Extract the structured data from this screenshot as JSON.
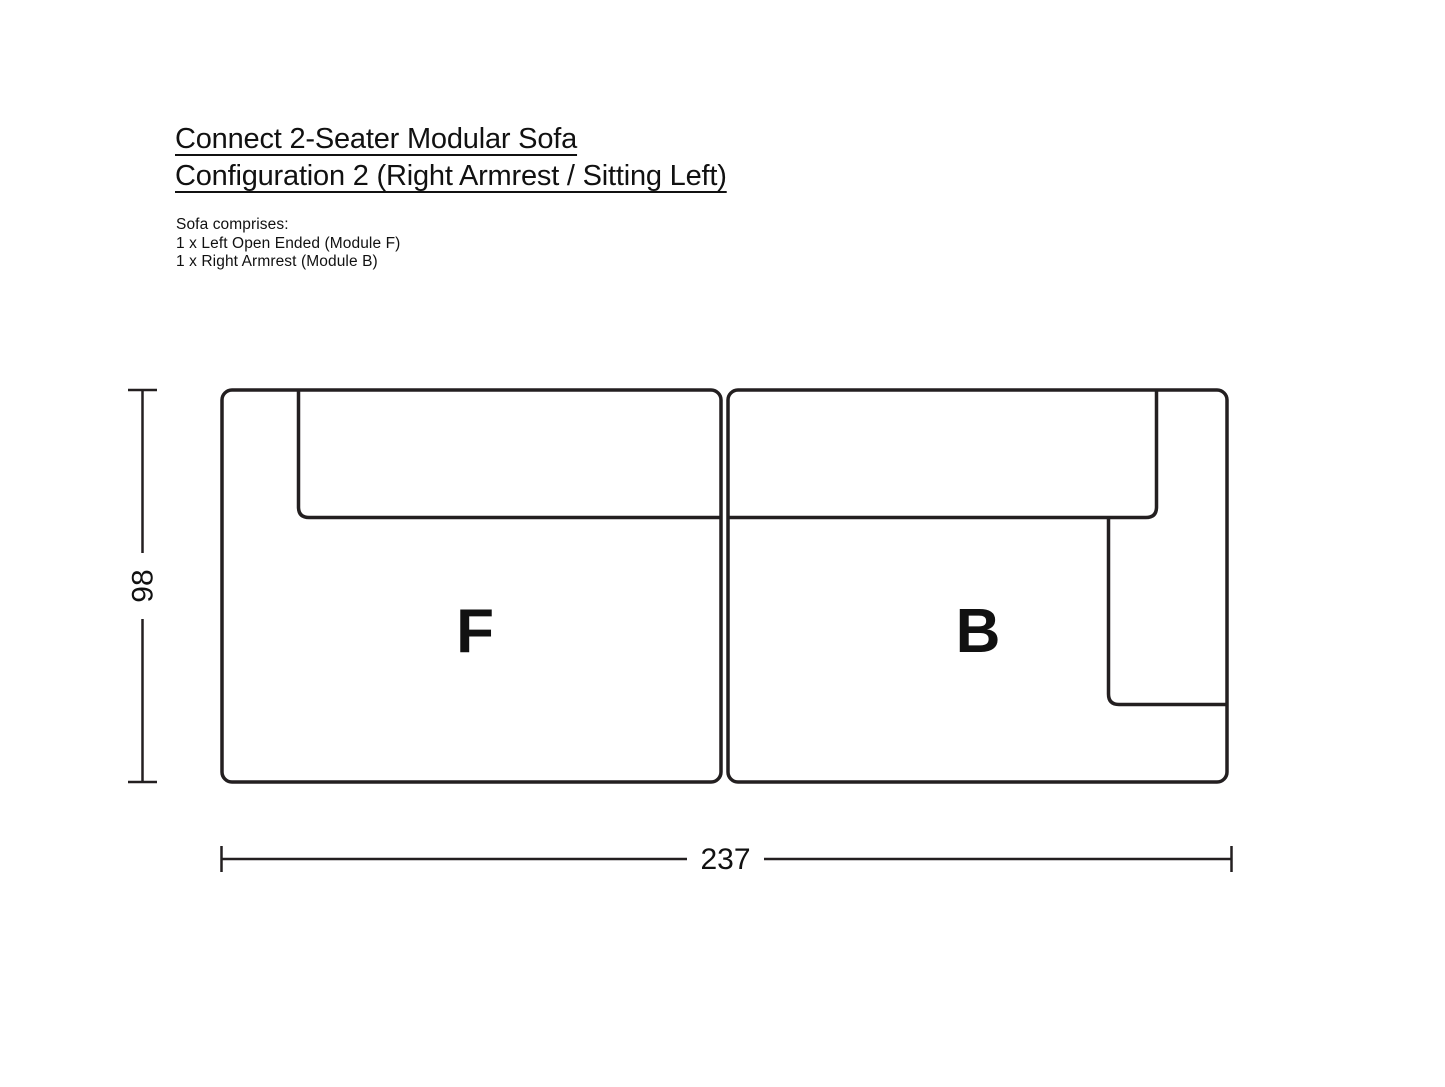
{
  "title": {
    "line1": "Connect 2-Seater Modular Sofa",
    "line2": "Configuration 2 (Right Armrest / Sitting Left)"
  },
  "comprises": {
    "intro": "Sofa comprises:",
    "items": [
      "1 x Left Open Ended (Module F)",
      "1 x Right Armrest (Module B)"
    ]
  },
  "diagram": {
    "module_f_label": "F",
    "module_b_label": "B",
    "depth_dimension": "98",
    "width_dimension": "237",
    "line_color": "#231f20",
    "text_color": "#111111"
  }
}
